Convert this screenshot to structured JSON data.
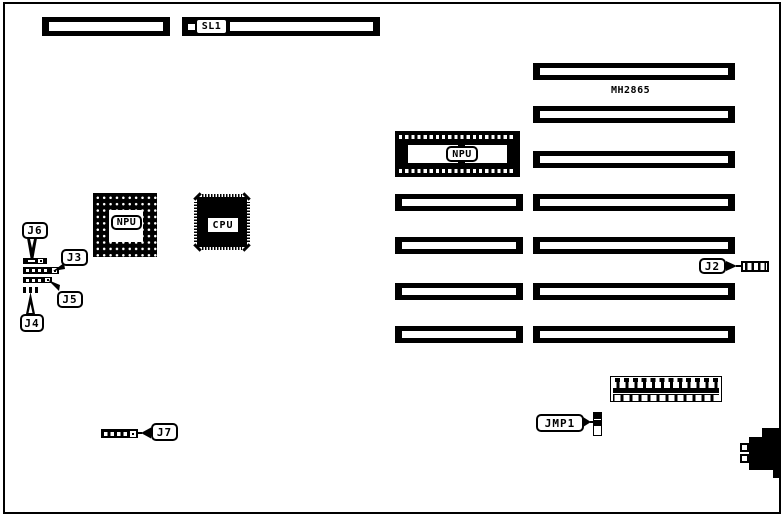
{
  "board": {
    "model_label": "MH2865"
  },
  "callouts": {
    "sl1": "SL1",
    "j2": "J2",
    "j3": "J3",
    "j4": "J4",
    "j5": "J5",
    "j6": "J6",
    "j7": "J7",
    "jmp1": "JMP1"
  },
  "chips": {
    "npu_socket_label": "NPU",
    "npu_chip_label": "NPU",
    "cpu_label": "CPU"
  },
  "colors": {
    "ink": "#000000",
    "paper": "#ffffff"
  }
}
